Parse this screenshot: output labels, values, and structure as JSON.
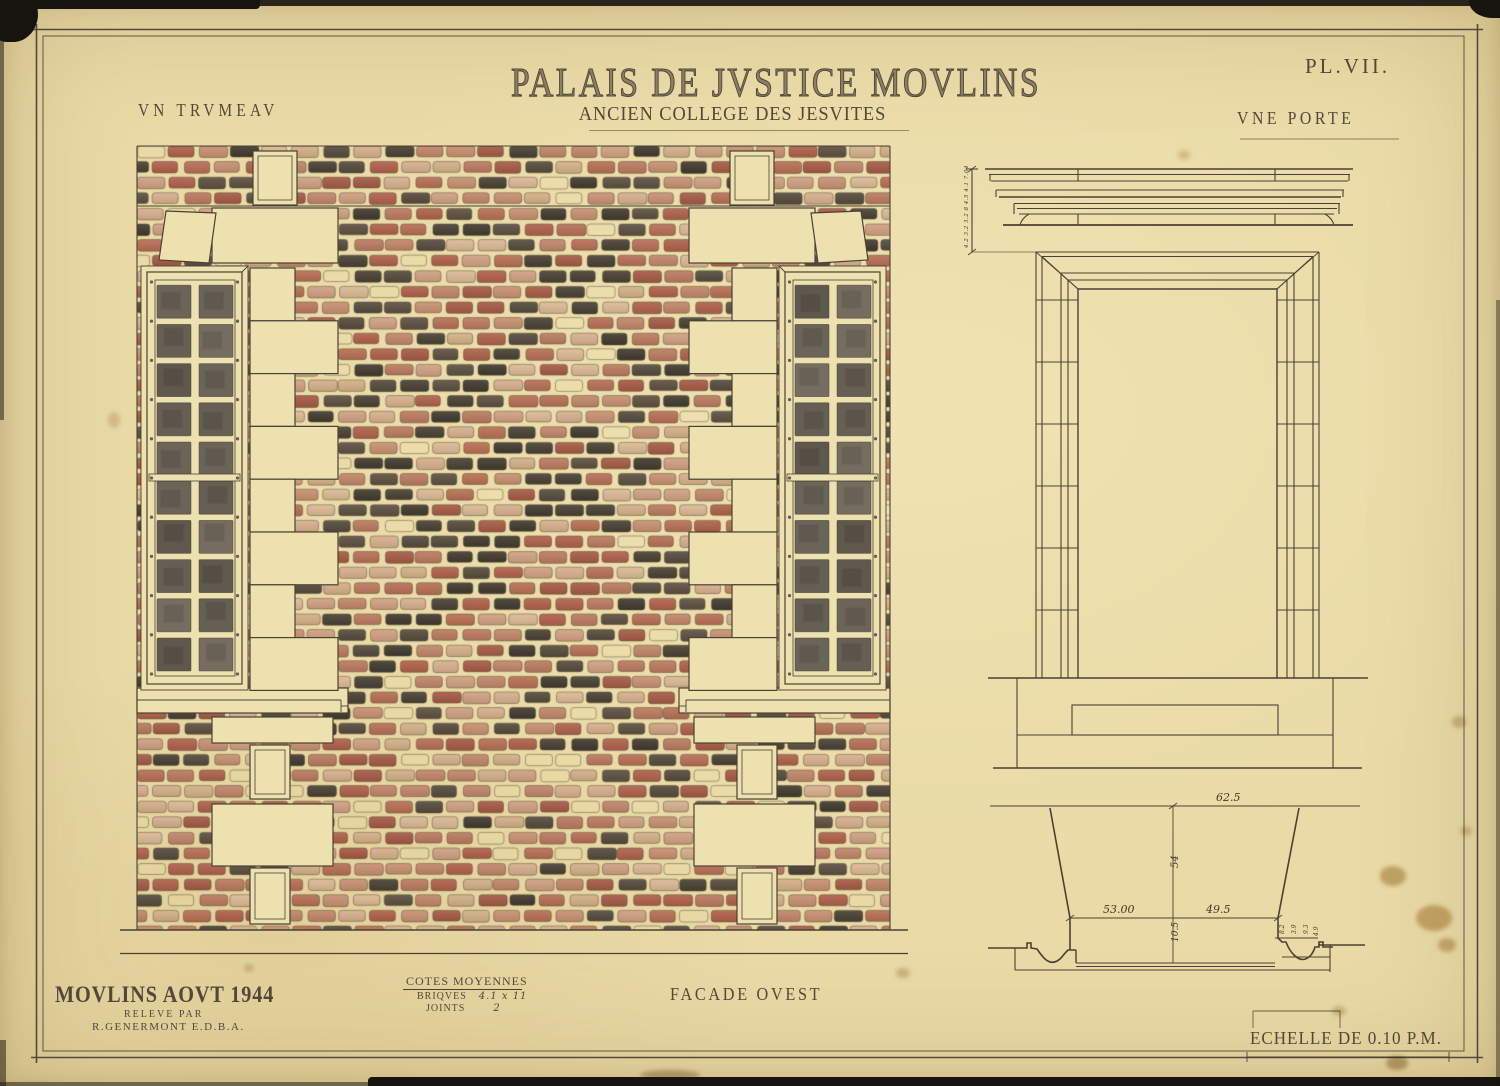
{
  "plate": {
    "title": "PALAIS DE JVSTICE MOVLINS",
    "subtitle": "ANCIEN COLLEGE DES JESVITES",
    "plate_number": "PL.VII.",
    "label_trumeau": "VN TRVMEAV",
    "label_porte": "VNE PORTE"
  },
  "footer": {
    "place_date": "MOVLINS AOVT 1944",
    "survey_line1": "RELEVE PAR",
    "survey_line2": "R.GENERMONT  E.D.B.A.",
    "notes_title": "COTES MOYENNES",
    "briques_label": "BRIQVES",
    "briques_value": "4.1 x 11",
    "joints_label": "JOINTS",
    "joints_value": "2",
    "facade_label": "FACADE OVEST",
    "scale_label": "ECHELLE DE 0.10 P.M."
  },
  "door_dims": {
    "width_total": "62.5",
    "width_outer": "53.00",
    "width_inner": "49.5",
    "depth": "54",
    "jamb": "10.5",
    "small": [
      "8.2",
      "3.9",
      "9.3",
      "4.9"
    ],
    "cornice_stack": "4.2 3.2 3.2 8 4.5 4.1 7.04"
  },
  "colors": {
    "paper": "#e9daa6",
    "stone": "#eee1b0",
    "ink": "#4a4134",
    "brick_red": [
      "#a85c4a",
      "#b06a54",
      "#9e5544",
      "#b4755f"
    ],
    "brick_pink": [
      "#c18b71",
      "#c99b81",
      "#d0aa8d",
      "#ba8169"
    ],
    "brick_dark": [
      "#423c33",
      "#4e463c",
      "#3a352e",
      "#564b40"
    ],
    "brick_light": [
      "#d4b494",
      "#ccab87"
    ],
    "pane": [
      "#6b6459",
      "#5f584d",
      "#756d60",
      "#665f53"
    ]
  }
}
